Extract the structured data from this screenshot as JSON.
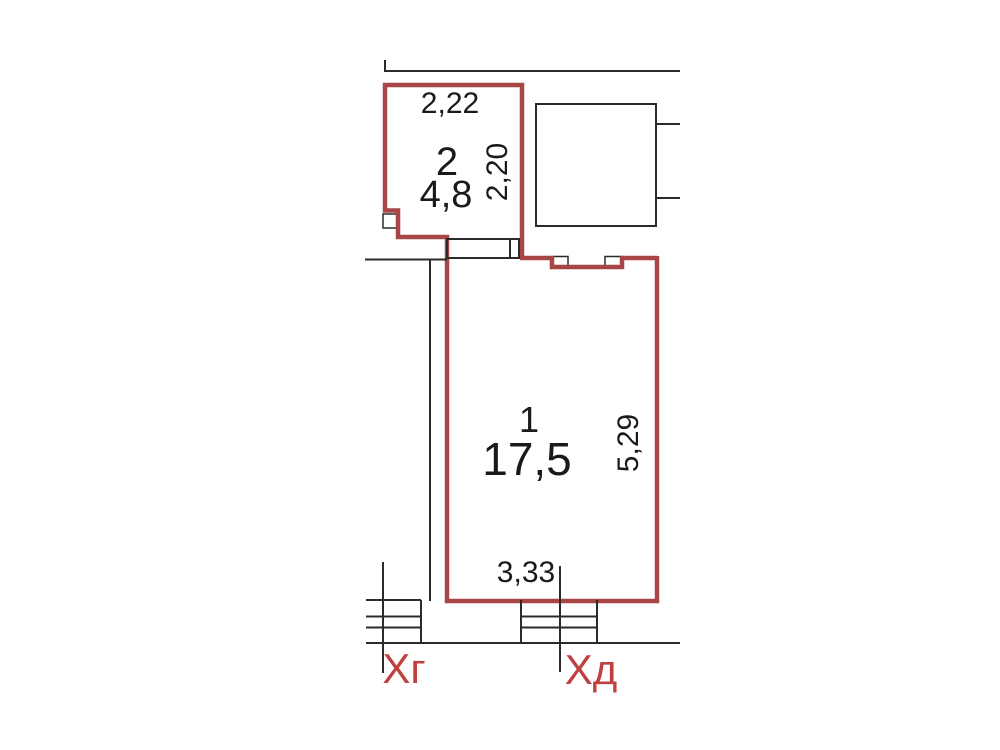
{
  "document": {
    "type": "floor-plan",
    "colors": {
      "background": "#ffffff",
      "wall": "#a84545",
      "line": "#2b2b2b",
      "axis_label": "#c04040"
    }
  },
  "rooms": [
    {
      "number": "1",
      "area": "17,5",
      "width_dimension": "3,33",
      "depth_dimension": "5,29"
    },
    {
      "number": "2",
      "area": "4,8",
      "width_dimension": "2,22",
      "depth_dimension": "2,20"
    }
  ],
  "axes": [
    {
      "label": "Хг"
    },
    {
      "label": "Хд"
    }
  ]
}
